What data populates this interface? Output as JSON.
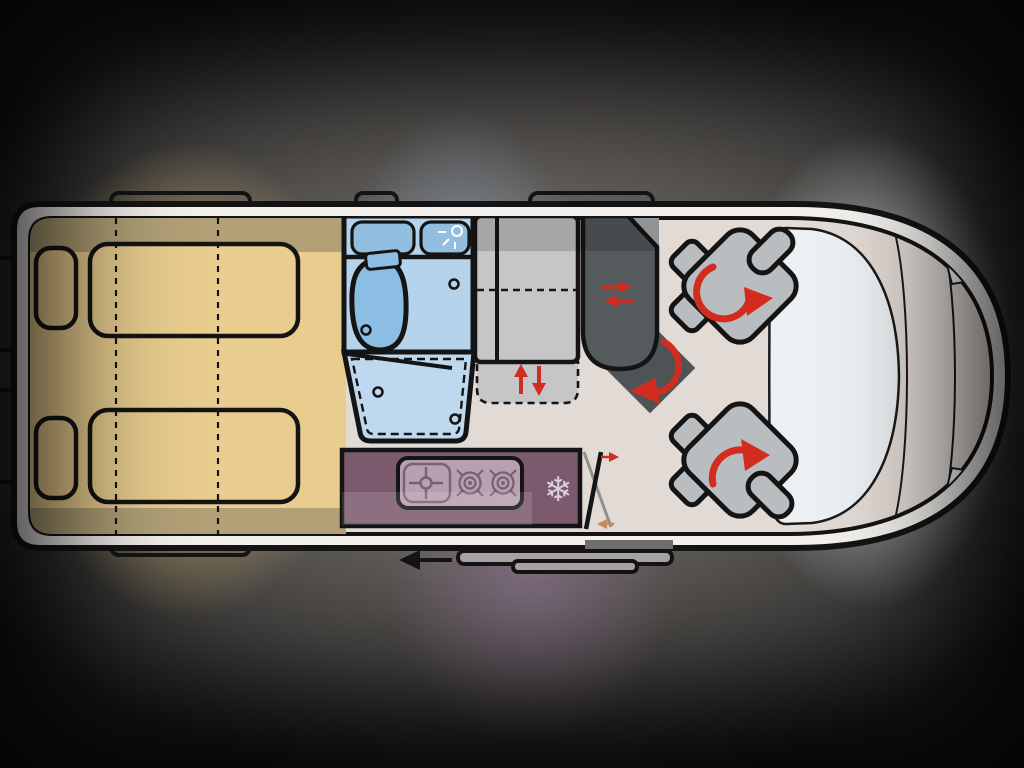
{
  "colors": {
    "outline": "#141414",
    "body_white": "#f2efec",
    "floor": "#e2dad4",
    "bed_light": "#e9cd8e",
    "bed_dark": "#b2a176",
    "bath_bg": "#b5d3ea",
    "bath_cabinet": "#92bedf",
    "toilet": "#8cbde2",
    "shower": "#bed9ef",
    "unit_gray": "#c6c6c6",
    "bench_dark": "#555a5c",
    "bench_corner": "#aeb0b1",
    "square_dark": "#4e5355",
    "seat_gray": "#b9bdbf",
    "kitchen_purple": "#7b5a6e",
    "stove_panel": "#b7a0af",
    "stove_icon": "#7a5f72",
    "snowflake": "#dccfdc",
    "windshield": "#edf0f2",
    "headlight": "#f3f5f6",
    "accent_red": "#d22b20",
    "arrow_tan": "#c28a62",
    "door_gray_line": "#8f8f8c",
    "step_gray": "#6e6e6b",
    "rail_fill": "#a8a1a5",
    "exterior_tab_dark": "#35322b"
  },
  "icons": {
    "fridge_glyph": "❄",
    "shower_icon": "shower-spray",
    "sink_icon": "sink-crosshair",
    "stove_burner_icon": "gas-burner-ring",
    "seat_rotation_icon": "red-curved-arrow",
    "bench_slide_icon": "red-left-right-arrows",
    "bed_lift_icon": "red-up-down-arrows",
    "door_swing_icon": "crossed-door-lines",
    "travel_direction_icon": "black-left-arrow"
  },
  "floorplan": {
    "vehicle": "campervan-top-view-floorplan",
    "areas": [
      "rear-transverse-double-beds",
      "bathroom-with-toilet",
      "fold-out-shower-tray",
      "wardrobe-with-lift-section",
      "dinette-bench",
      "rotating-table",
      "kitchen-unit-sink-two-burners",
      "fridge",
      "sliding-entry-door",
      "swivel-cab-seat-left",
      "swivel-cab-seat-right",
      "cab-windshield-and-hood"
    ]
  }
}
